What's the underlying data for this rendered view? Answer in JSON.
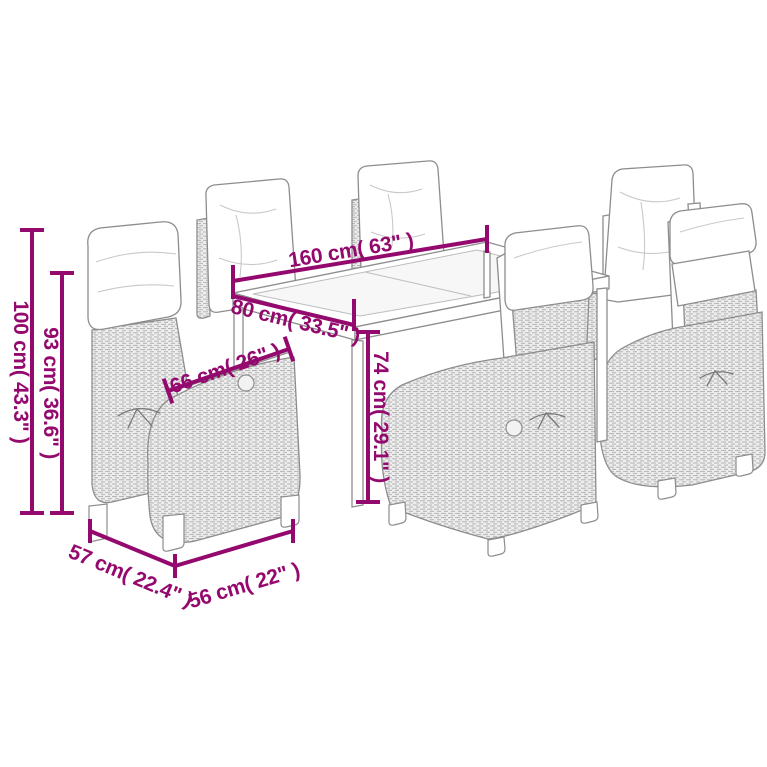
{
  "scene": {
    "background_color": "#ffffff",
    "accent_color": "#94096d",
    "line_art_color": "#8d8d8d",
    "subject": "7-piece garden dining set: rectangular table with glass top and 6 reclining poly-rattan chairs with cushions"
  },
  "dimensions": {
    "table_length": "160 cm( 63\" )",
    "table_width": "80 cm( 33.5\" )",
    "armrest_length": "66 cm( 26\" )",
    "table_height": "74 cm( 29.1\" )",
    "chair_height": "100 cm( 43.3\" )",
    "chair_backrest_height": "93 cm( 36.6\" )",
    "chair_width": "57 cm( 22.4\" )",
    "chair_depth": "56 cm( 22\" )"
  }
}
